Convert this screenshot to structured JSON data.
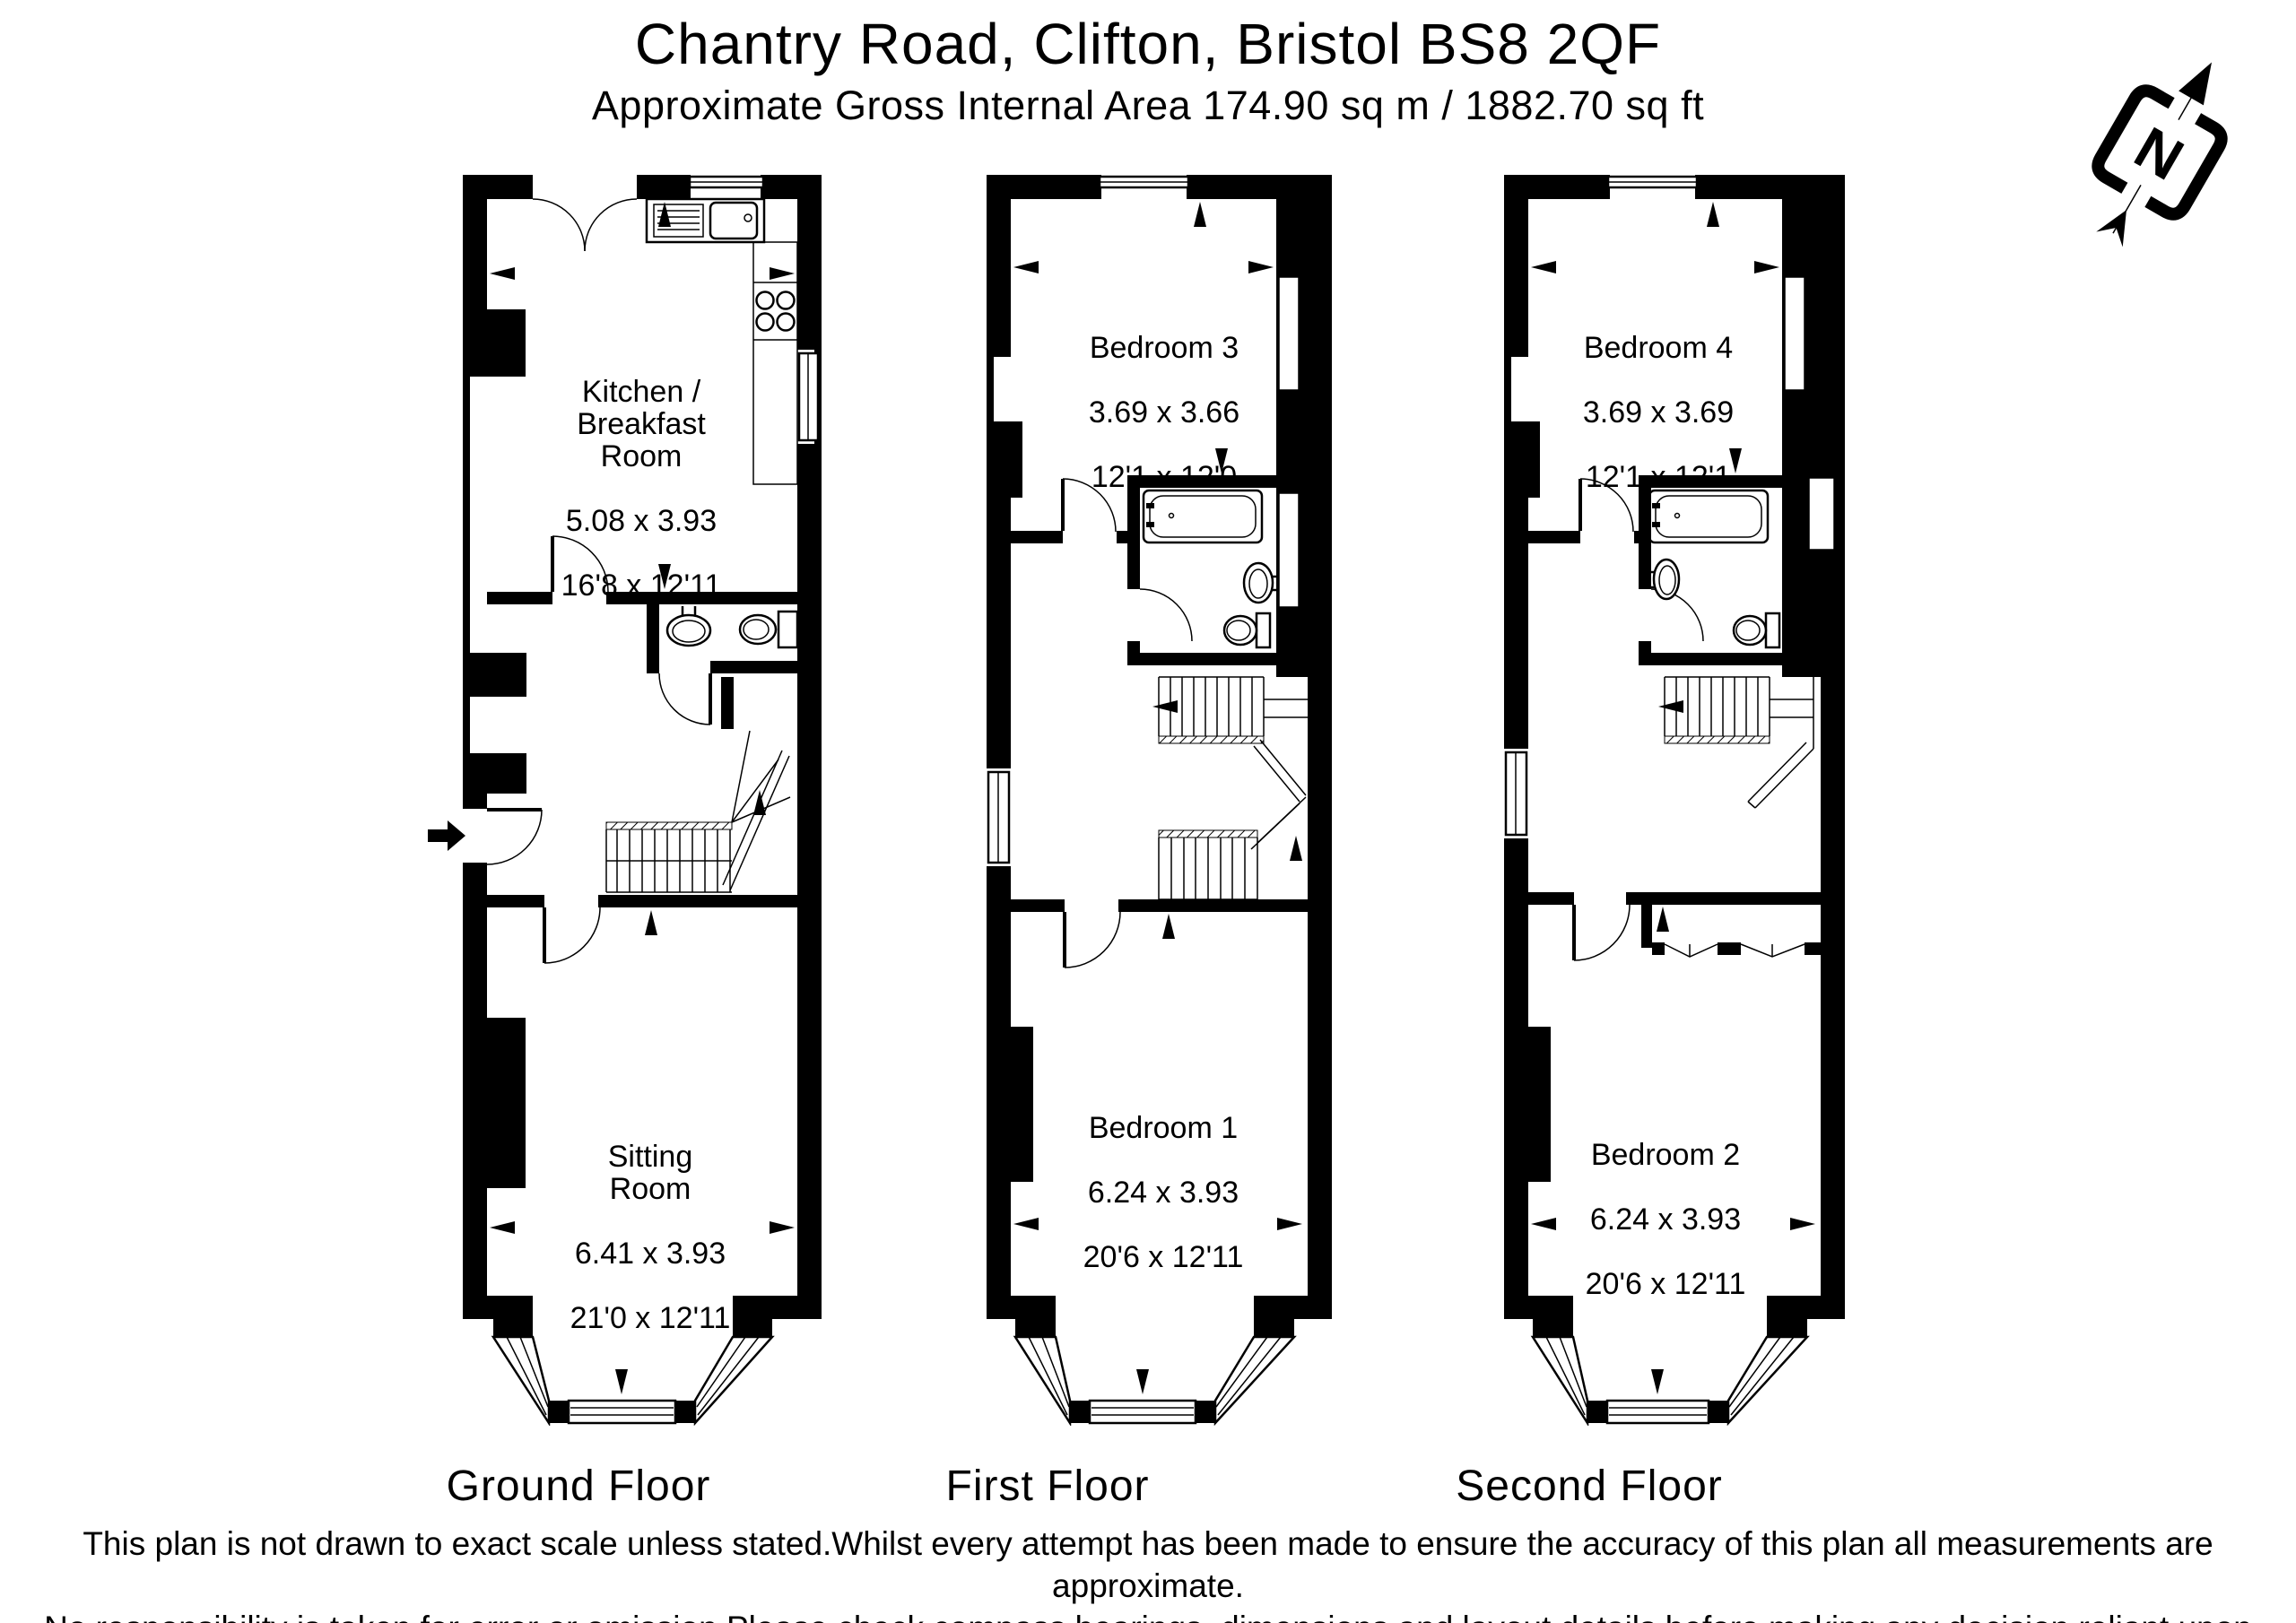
{
  "header": {
    "title": "Chantry Road, Clifton, Bristol BS8 2QF",
    "subtitle": "Approximate Gross Internal Area 174.90 sq m / 1882.70 sq ft"
  },
  "compass": {
    "letter": "N"
  },
  "floors": [
    {
      "label": "Ground Floor",
      "rooms": [
        {
          "name": "Kitchen /\nBreakfast Room",
          "metric": "5.08 x 3.93",
          "imperial": "16'8 x 12'11"
        },
        {
          "name": "Sitting Room",
          "metric": "6.41 x 3.93",
          "imperial": "21'0 x 12'11"
        }
      ]
    },
    {
      "label": "First Floor",
      "rooms": [
        {
          "name": "Bedroom 3",
          "metric": "3.69 x 3.66",
          "imperial": "12'1 x 12'0"
        },
        {
          "name": "Bedroom 1",
          "metric": "6.24 x 3.93",
          "imperial": "20'6 x 12'11"
        }
      ]
    },
    {
      "label": "Second Floor",
      "rooms": [
        {
          "name": "Bedroom 4",
          "metric": "3.69 x 3.69",
          "imperial": "12'1 x 12'1"
        },
        {
          "name": "Bedroom 2",
          "metric": "6.24 x 3.93",
          "imperial": "20'6 x 12'11"
        }
      ]
    }
  ],
  "disclaimer": {
    "line1": "This plan is not drawn to exact scale unless stated.Whilst every attempt has been made to ensure the accuracy of this plan all measurements are approximate.",
    "line2": "No responsibility is taken for error or omission.Please check compass bearings, dimensions and layout details before making any decision reliant upon them."
  },
  "colors": {
    "ink": "#000000",
    "paper": "#ffffff"
  }
}
